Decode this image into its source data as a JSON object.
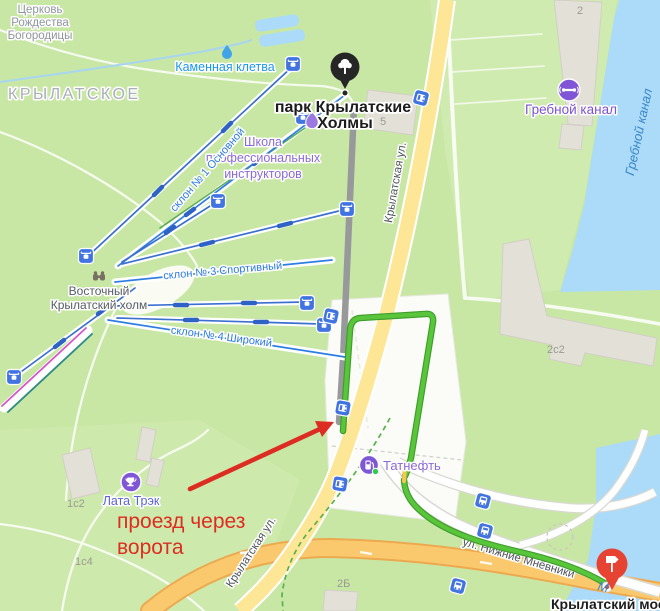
{
  "map": {
    "district": "КРЫЛАТСКОЕ",
    "church": {
      "l1": "Церковь",
      "l2": "Рождества",
      "l3": "Богородицы"
    },
    "stone_cleft": "Каменная клетва",
    "park": {
      "l1": "парк Крылатские",
      "l2": "Холмы"
    },
    "school": {
      "l1": "Школа",
      "l2": "профессиональных",
      "l3": "инструкторов"
    },
    "hill": {
      "l1": "Восточный",
      "l2": "Крылатский холм"
    },
    "slopes": {
      "s1": "склон № 1 Основной",
      "s3": "склон № 3 Спортивный",
      "s4": "склон № 4 Широкий"
    },
    "streets": {
      "top": "Крылатская ул.",
      "bottom": "Крылатская ул.",
      "nizhnie": "ул. Нижние Мнёвники",
      "bridge": "Крылатский мост"
    },
    "water": {
      "canal": "Гребной канал",
      "river_initial": "М"
    },
    "pois": {
      "rowing": "Гребной канал",
      "gas": "Татнефть",
      "track": "Лата Трэк"
    },
    "buildings": {
      "b5": "5",
      "b2": "2",
      "b2c2": "2с2",
      "b2b": "2Б",
      "b1c2": "1с2",
      "b1c4": "1с4"
    },
    "annotation": {
      "l1": "проезд через",
      "l2": "ворота"
    },
    "colors": {
      "route_green": "#58c53b",
      "route_traffic_yellow": "#f2c94c",
      "road_yellow": "#fde696",
      "highway_orange": "#fbc96d",
      "water_blue": "#abdbf8",
      "park_green": "#c9e7a4",
      "annotation_red": "#dd2d22",
      "transit_icon_blue": "#4174e0",
      "poi_purple": "#8760d8",
      "slope_blue": "#2e7de2"
    },
    "icons": {
      "ski_lift": "cable-car",
      "bus_stop": "bus",
      "park_pin": "tree",
      "destination_pin": "signpost",
      "rowing": "rowing-machine",
      "trophy": "trophy",
      "fuel": "fuel-pump",
      "binoculars": "binoculars",
      "spring": "water-drop"
    }
  }
}
